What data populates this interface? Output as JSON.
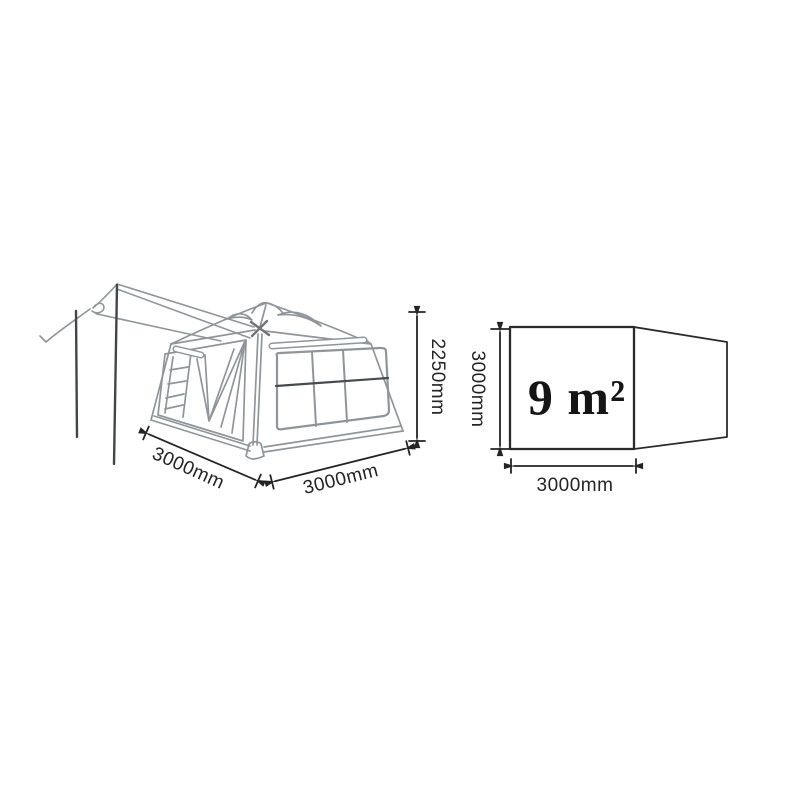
{
  "diagram": {
    "title_hint": "tent-dimension-diagram",
    "tent": {
      "width_label": "3000mm",
      "depth_label": "3000mm",
      "height_label": "2250mm"
    },
    "floor_plan": {
      "area_label": "9 m²",
      "side_label": "3000mm",
      "width_label": "3000mm"
    },
    "colors": {
      "background": "#ffffff",
      "sketch_line": "#8f959b",
      "sketch_dark": "#42464a",
      "sketch_mid": "#6e7478",
      "window_bar": "#464b4f",
      "dimension": "#242424",
      "plan_line": "#2b2b2b"
    }
  }
}
